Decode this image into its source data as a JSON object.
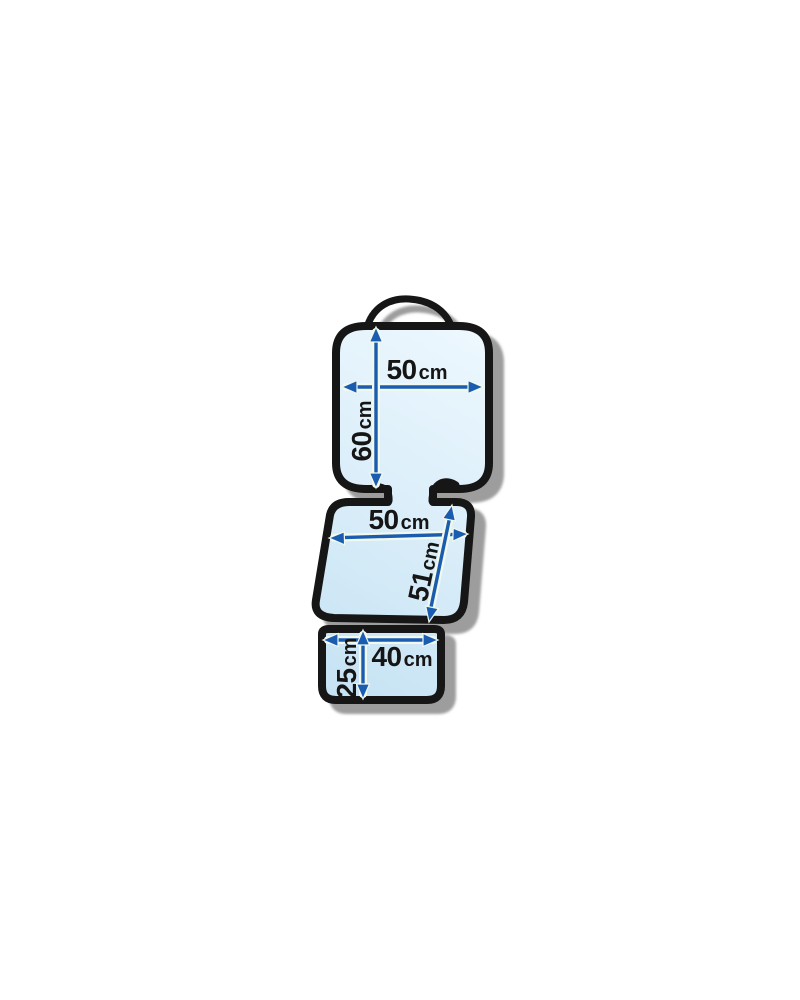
{
  "diagram": {
    "name": "car-seat-protector-dimension-diagram",
    "unit": "cm",
    "backrest": {
      "width_value": "50",
      "width_unit": "cm",
      "height_value": "60",
      "height_unit": "cm"
    },
    "seat": {
      "width_value": "50",
      "width_unit": "cm",
      "depth_value": "51",
      "depth_unit": "cm"
    },
    "flap": {
      "width_value": "40",
      "width_unit": "cm",
      "height_value": "25",
      "height_unit": "cm"
    },
    "colors": {
      "outline": "#161616",
      "fill_light": "#eef8fe",
      "fill_dark": "#c5e2f3",
      "arrow": "#1a5cb0",
      "arrow_halo": "#f1f8ee",
      "shadow": "#9d9d9d",
      "label_text": "#151515",
      "background": "#ffffff"
    }
  }
}
